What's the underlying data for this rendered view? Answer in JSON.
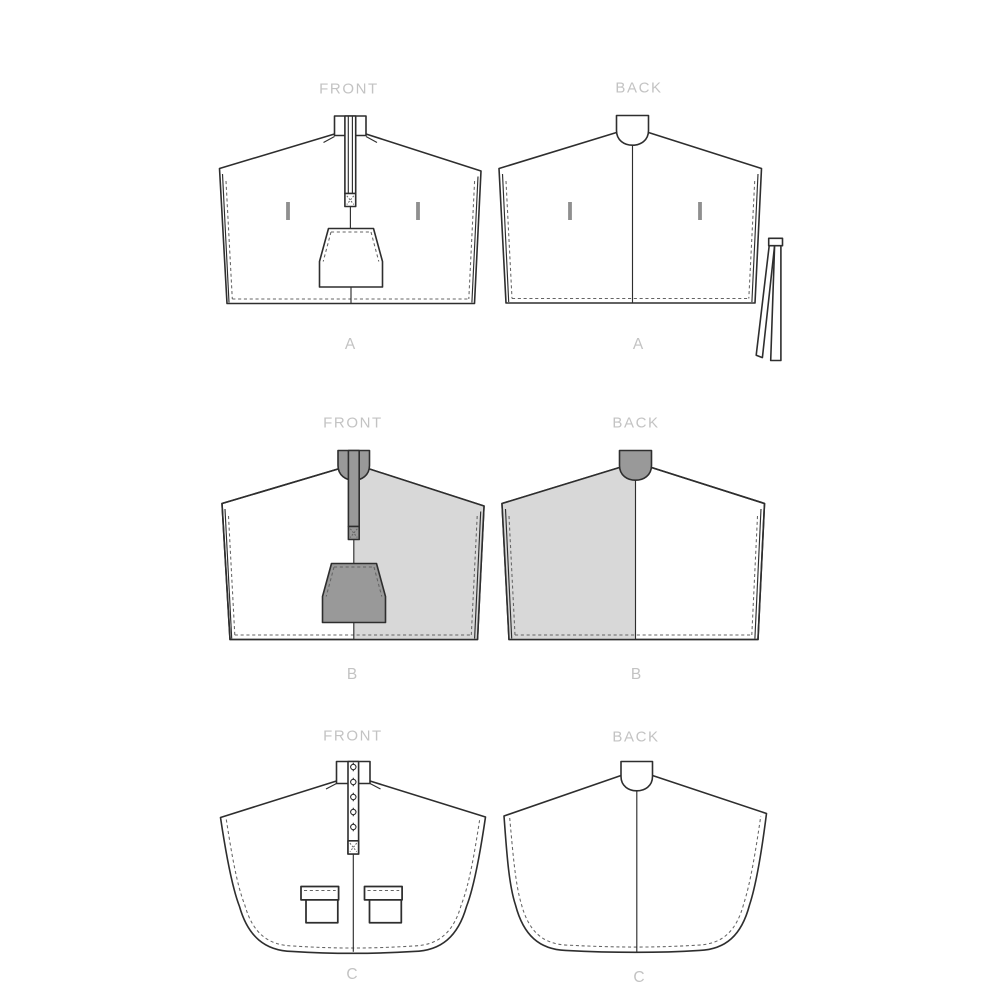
{
  "canvas": {
    "width": 1000,
    "height": 1000
  },
  "colors": {
    "paper": "#ffffff",
    "line": "#2e2e2e",
    "stitch": "#646464",
    "fill-light": "#d8d8d8",
    "fill-dark": "#999999",
    "slit": "#8f8f8f",
    "label": "#c3c3c3"
  },
  "panels": [
    {
      "id": "view-a-front",
      "orientation_label": "FRONT",
      "view_label": "A",
      "description": "Cape view A front: stand collar, center zipper placket with bar tack, stuff pouch, two hand-slit openings, dashed edge stitching"
    },
    {
      "id": "view-a-back",
      "orientation_label": "BACK",
      "view_label": "A",
      "description": "Cape view A back: stand collar with neck curve, center back seam, two slit openings, separate folded tie strap at right"
    },
    {
      "id": "view-b-front",
      "orientation_label": "FRONT",
      "view_label": "B",
      "description": "Cape view B front: right half shaded contrast fabric, dark collar, dark zipper placket with bar tack, dark stuff pouch"
    },
    {
      "id": "view-b-back",
      "orientation_label": "BACK",
      "view_label": "B",
      "description": "Cape view B back: left half shaded contrast fabric, dark collar, center back seam"
    },
    {
      "id": "view-c-front",
      "orientation_label": "FRONT",
      "view_label": "C",
      "description": "Long rounded-hem cape view C front: stand collar, five-button placket with bar tack, two flap pockets, dashed hem stitching"
    },
    {
      "id": "view-c-back",
      "orientation_label": "BACK",
      "view_label": "C",
      "description": "Long rounded-hem cape view C back: stand collar with neck curve, center back seam, dashed hem stitching"
    }
  ]
}
